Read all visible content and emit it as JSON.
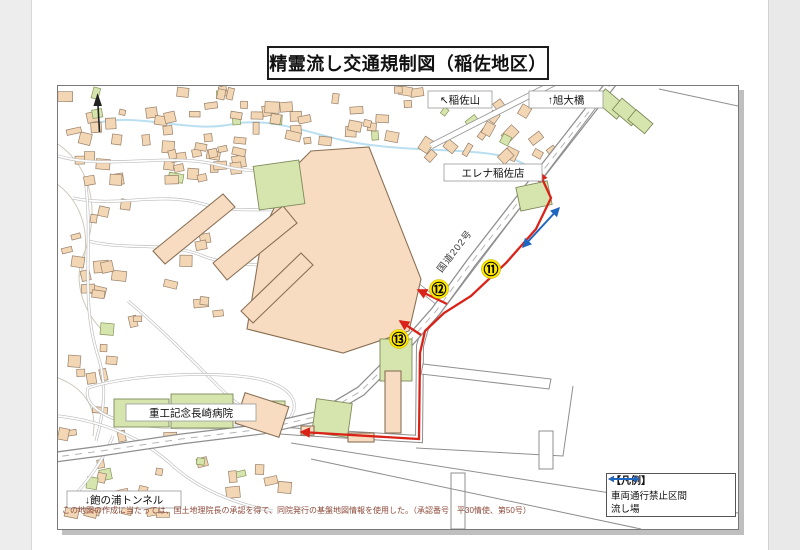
{
  "page": {
    "title": "精霊流し交通規制図（稲佐地区）"
  },
  "map": {
    "labels": [
      {
        "id": "inasayama",
        "text": "↖稲佐山",
        "x": 370,
        "y": 5,
        "w": 64
      },
      {
        "id": "asahi-bridge",
        "text": "↑旭大橋",
        "x": 471,
        "y": 5,
        "w": 74
      },
      {
        "id": "elena-store",
        "text": "エレナ稲佐店",
        "x": 386,
        "y": 78,
        "w": 98
      },
      {
        "id": "hospital",
        "text": "重工記念長崎病院",
        "x": 68,
        "y": 318,
        "w": 130
      },
      {
        "id": "tunnel",
        "text": "↓飽の浦トンネル",
        "x": 9,
        "y": 405,
        "w": 114
      }
    ],
    "road_label": {
      "text": "国道202号",
      "x": 399,
      "y": 167,
      "angle": -52
    },
    "badges": [
      {
        "num": "⑪",
        "x": 433,
        "y": 183
      },
      {
        "num": "⑫",
        "x": 381,
        "y": 203
      },
      {
        "num": "⑬",
        "x": 341,
        "y": 253
      }
    ],
    "routes": {
      "red": {
        "main": "481,86 493,112 478,143 448,177 413,210 386,227 367,245 362,267 361,353 243,346",
        "branches": [
          "389,218 360,204",
          "363,249 342,235"
        ]
      },
      "blue": {
        "main": "465,161 501,122"
      }
    },
    "legend": {
      "title": "【凡例】",
      "items": [
        {
          "id": "vehicle-ban",
          "color": "#d92318",
          "label": "車両通行禁止区間"
        },
        {
          "id": "nagashiba",
          "color": "#1f66c0",
          "label": "流し場"
        }
      ]
    },
    "attribution": "この地図の作成に当たっては、国土地理院長の承認を得て、同院発行の基盤地図情報を使用した。（承認番号　平30情使、第50号）",
    "colors": {
      "red_route": "#d92318",
      "blue_route": "#1f66c0",
      "badge_yellow": "#ffe800",
      "building_tan": "#f3d6b4",
      "green_area": "#d6e5ae",
      "road_casing": "#8f8f8f"
    }
  }
}
